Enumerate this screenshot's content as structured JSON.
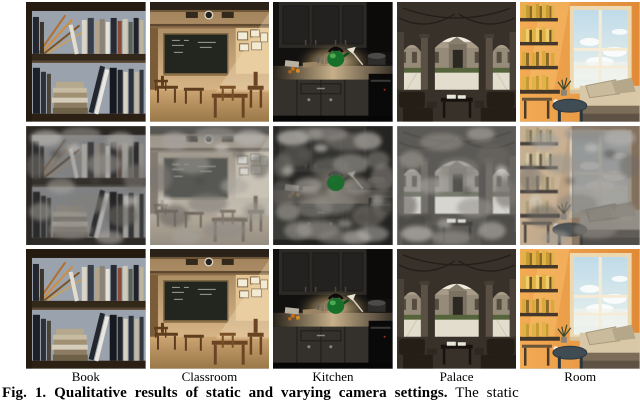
{
  "figure": {
    "row_labels": [
      "Static",
      "Varying",
      "Varying w\\ ours"
    ],
    "column_labels": [
      "Book",
      "Classroom",
      "Kitchen",
      "Palace",
      "Room"
    ],
    "caption": {
      "bold": "Fig. 1. Qualitative results of static and varying camera settings.",
      "rest": " The static"
    },
    "colors": {
      "degraded_overlay_gray": "#8e8b84",
      "kettle_green": "#167029",
      "room_sunset_orange": "#e89a42",
      "classroom_wood": "#b89570",
      "book_wall_gray": "#99a2ad"
    }
  }
}
